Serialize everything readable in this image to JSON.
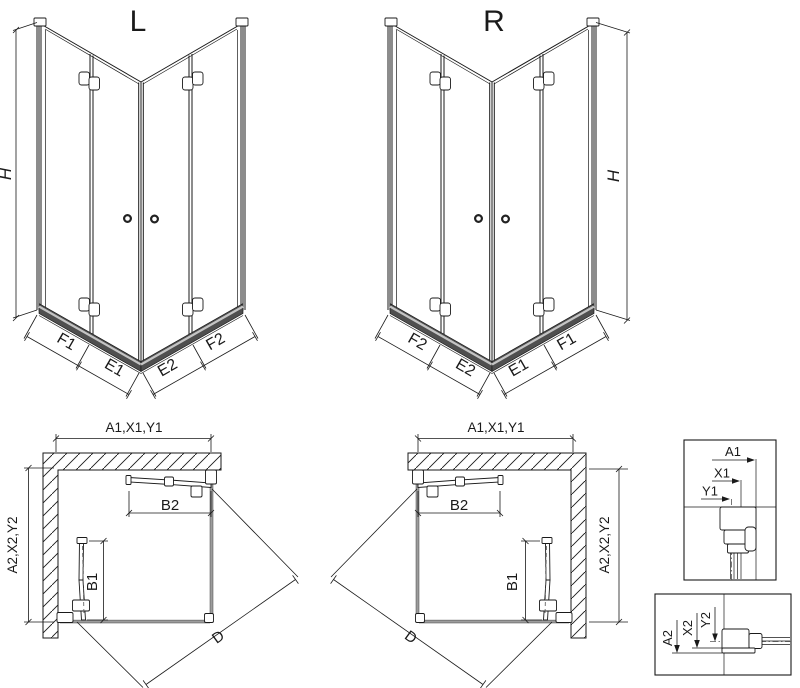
{
  "views": {
    "l3d": {
      "title": "L",
      "height_label": "H",
      "segments": [
        "F1",
        "E1",
        "E2",
        "F2"
      ]
    },
    "r3d": {
      "title": "R",
      "height_label": "H",
      "segments": [
        "F2",
        "E2",
        "E1",
        "F1"
      ]
    },
    "lplan": {
      "top_dim": "A1,X1,Y1",
      "side_dim": "A2,X2,Y2",
      "door_top": "B2",
      "door_side": "B1",
      "diagonal": "D"
    },
    "rplan": {
      "top_dim": "A1,X1,Y1",
      "side_dim": "A2,X2,Y2",
      "door_top": "B2",
      "door_side": "B1",
      "diagonal": "D"
    },
    "detail_top": {
      "a": "A1",
      "x": "X1",
      "y": "Y1"
    },
    "detail_bottom": {
      "a": "A2",
      "x": "X2",
      "y": "Y2"
    }
  },
  "colors": {
    "line": "#1a1a1a",
    "glass": "#9c9c9c",
    "rail_dark": "#4f4f4f",
    "rail_light": "#c4c4c4"
  }
}
